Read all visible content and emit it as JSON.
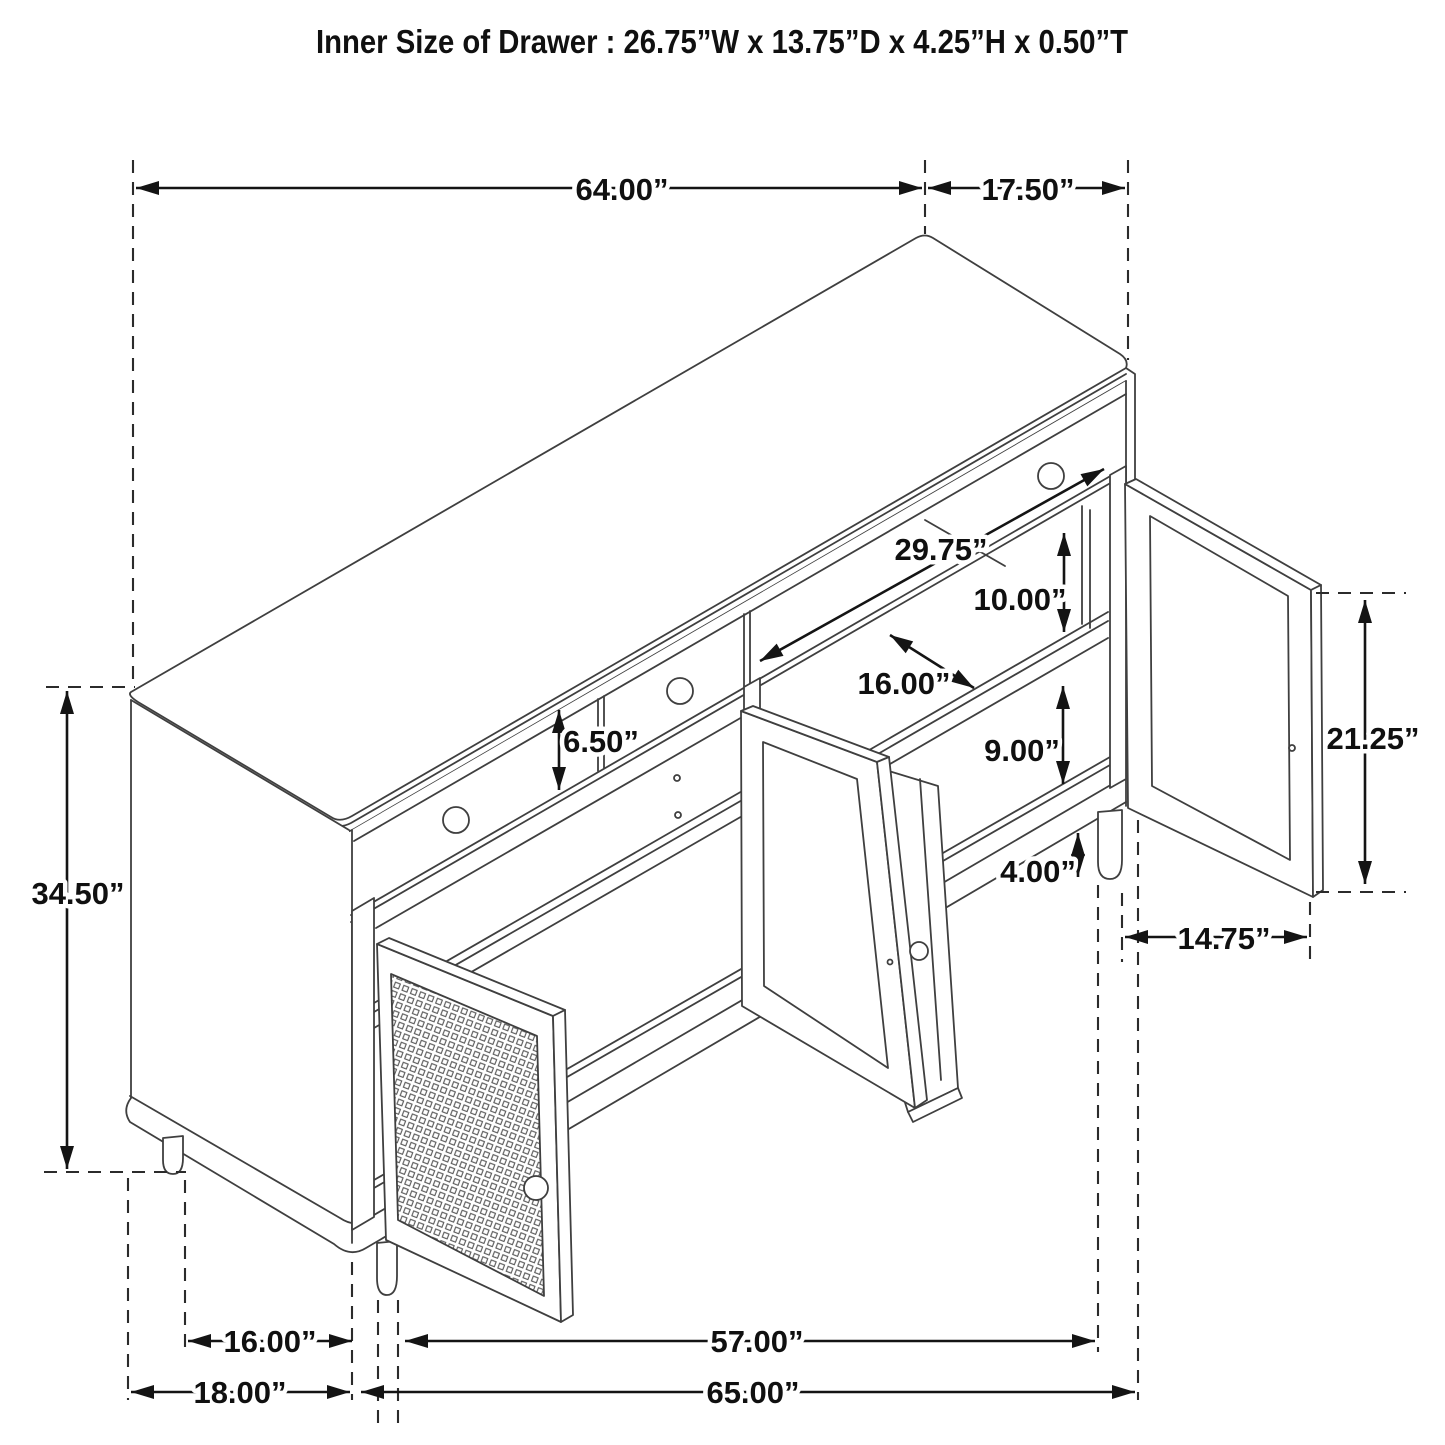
{
  "title": "Inner Size of Drawer  : 26.75”W x 13.75”D x 4.25”H x 0.50”T",
  "dimensions": {
    "top_width": "64.00”",
    "top_depth": "17.50”",
    "opening_width": "29.75”",
    "upper_clearance": "10.00”",
    "shelf_depth": "16.00”",
    "lower_clearance": "9.00”",
    "drawer_front_height": "6.50”",
    "leg_height": "4.00”",
    "door_height": "21.25”",
    "door_width": "14.75”",
    "overall_height": "34.50”",
    "left_section_width": "16.00”",
    "right_section_width": "57.00”",
    "left_base_width": "18.00”",
    "overall_width": "65.00”"
  },
  "colors": {
    "background": "#ffffff",
    "drawing_line": "#3f3f3f",
    "dimension_line": "#141414"
  }
}
